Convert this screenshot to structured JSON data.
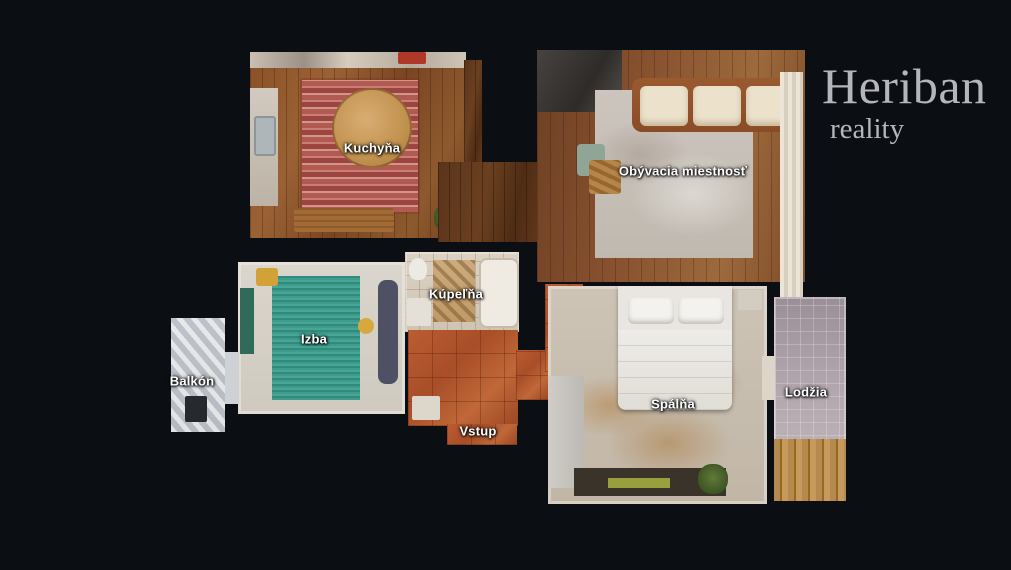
{
  "background_color": "#0b0e13",
  "logo": {
    "name": "Heriban",
    "tagline": "reality",
    "color": "#b5b6bb"
  },
  "rooms": [
    {
      "id": "kuchyna",
      "label": "Kuchyňa"
    },
    {
      "id": "obyvacia-miestnost",
      "label": "Obývacia miestnosť"
    },
    {
      "id": "izba",
      "label": "Izba"
    },
    {
      "id": "kupelna",
      "label": "Kúpeľňa"
    },
    {
      "id": "balkon",
      "label": "Balkón"
    },
    {
      "id": "vstup",
      "label": "Vstup"
    },
    {
      "id": "spalna",
      "label": "Spálňa"
    },
    {
      "id": "lodzia",
      "label": "Lodžia"
    }
  ],
  "label_color": "#ffffff",
  "floor_palette": {
    "wood_light": "#9a6234",
    "wood_dark": "#5a341a",
    "terracotta": "#b05630",
    "teal_rug": "#3d9c8c",
    "living_rug": "#c8c1b9",
    "bedroom_carpet": "#c9bfb0",
    "kitchen_rug": "#b25a52",
    "loggia_tile": "#b2a7ae",
    "balcony_tile": "#c9cdd2",
    "bathroom_tile": "#d7ccbc"
  }
}
